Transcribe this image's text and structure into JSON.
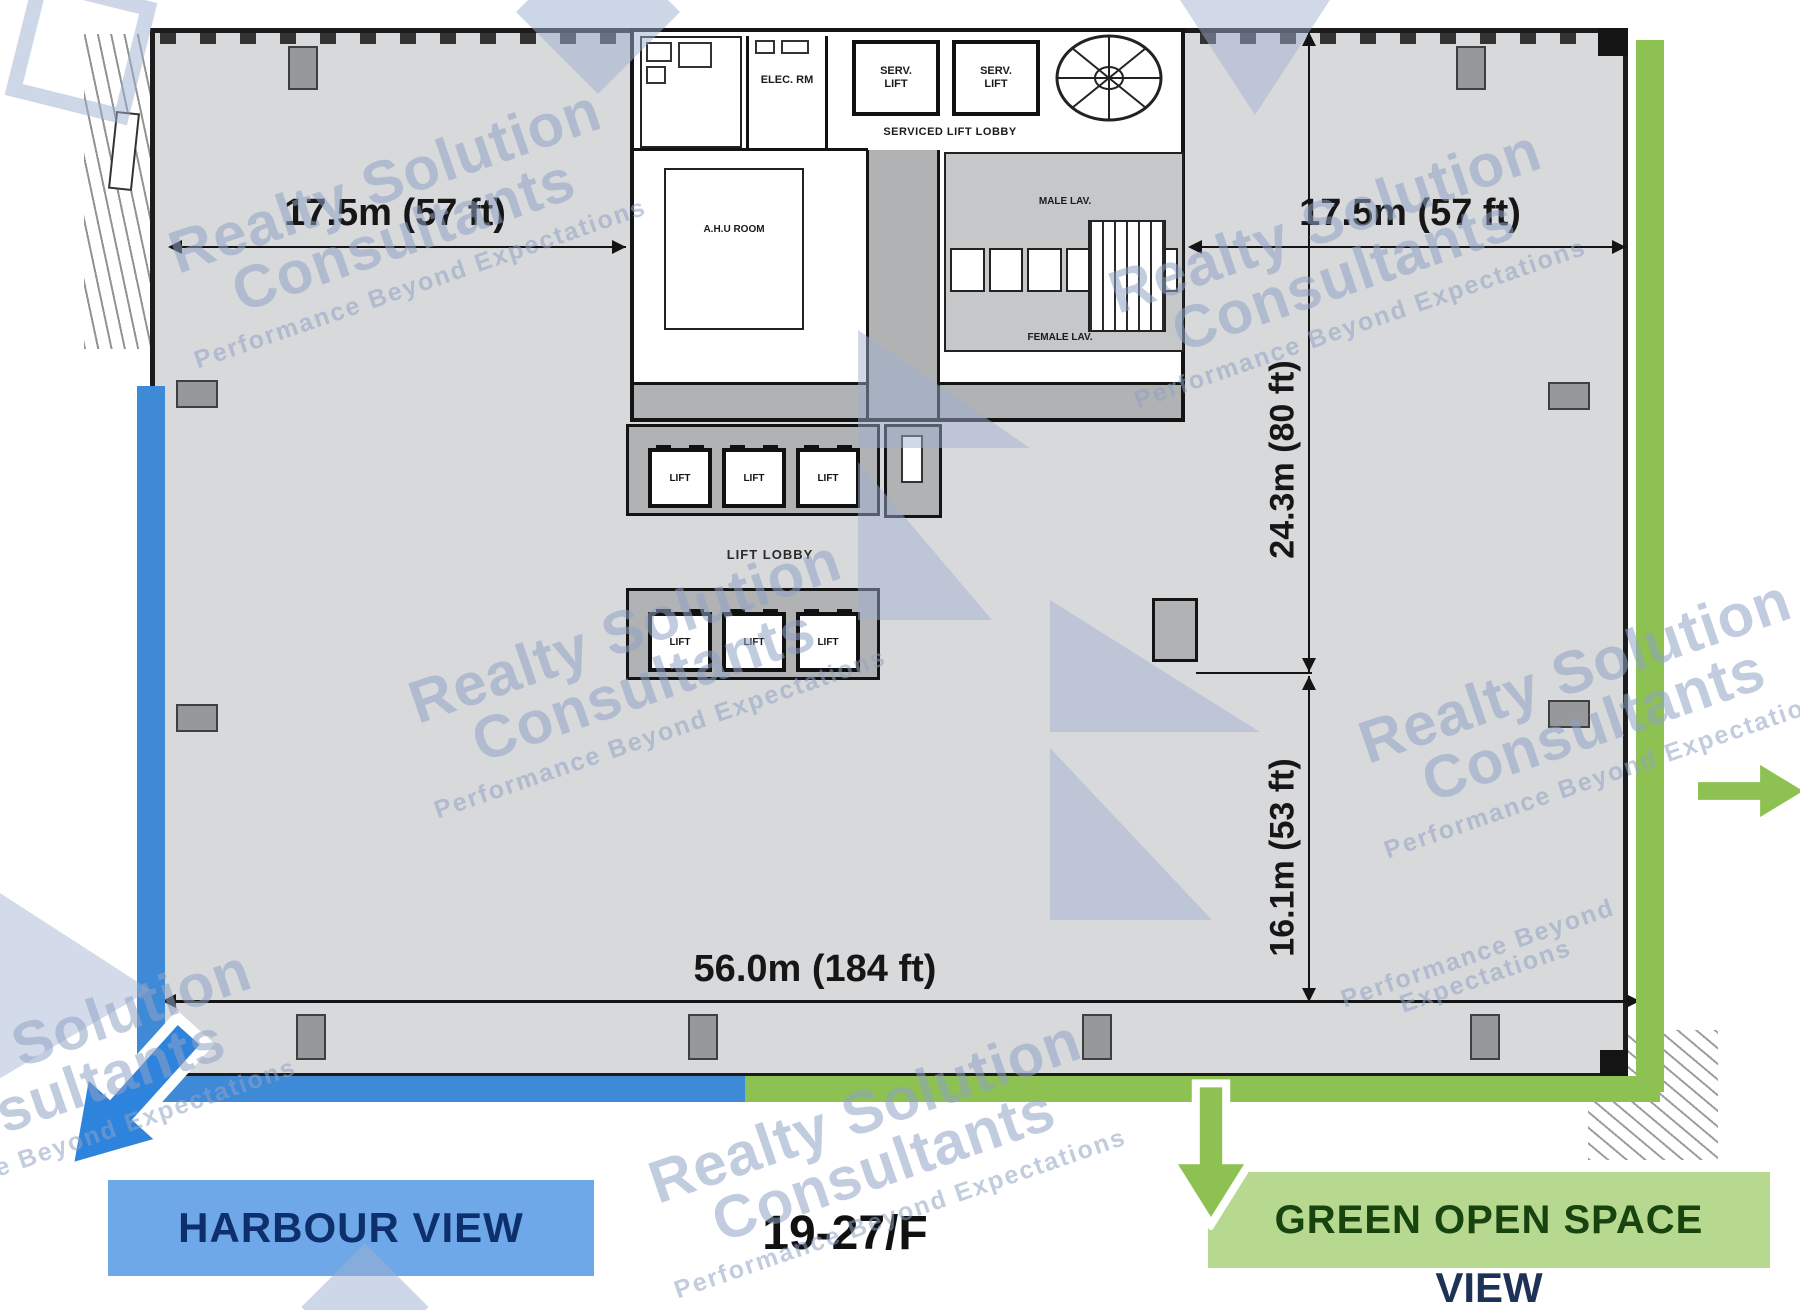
{
  "watermark": {
    "line1": "Realty Solution",
    "line2": "Consultants",
    "tagline": "Performance Beyond Expectations"
  },
  "dimensions": {
    "left_width": "17.5m (57 ft)",
    "right_width": "17.5m (57 ft)",
    "core_depth": "24.3m (80 ft)",
    "lower_depth": "16.1m (53 ft)",
    "total_width": "56.0m (184 ft)"
  },
  "core": {
    "elec_room": "ELEC. RM",
    "serv_lift": "SERV. LIFT",
    "serviced_lift_lobby": "SERVICED LIFT LOBBY",
    "ahu_room": "A.H.U ROOM",
    "male_lav": "MALE LAV.",
    "female_lav": "FEMALE LAV.",
    "lift": "LIFT",
    "lift_lobby": "LIFT LOBBY"
  },
  "legend": {
    "harbour": {
      "label": "HARBOUR VIEW",
      "color": "#6fa8e8"
    },
    "green_space": {
      "line1": "GREEN OPEN SPACE",
      "line2": "VIEW",
      "color": "#b6d88f"
    },
    "floor": "19-27/F"
  },
  "colors": {
    "harbour_accent": "#2e84dc",
    "green_accent": "#8dc152",
    "plan_fill": "#d8d9db",
    "corridor_fill": "#b1b2b4",
    "watermark": "#90a2c4"
  }
}
